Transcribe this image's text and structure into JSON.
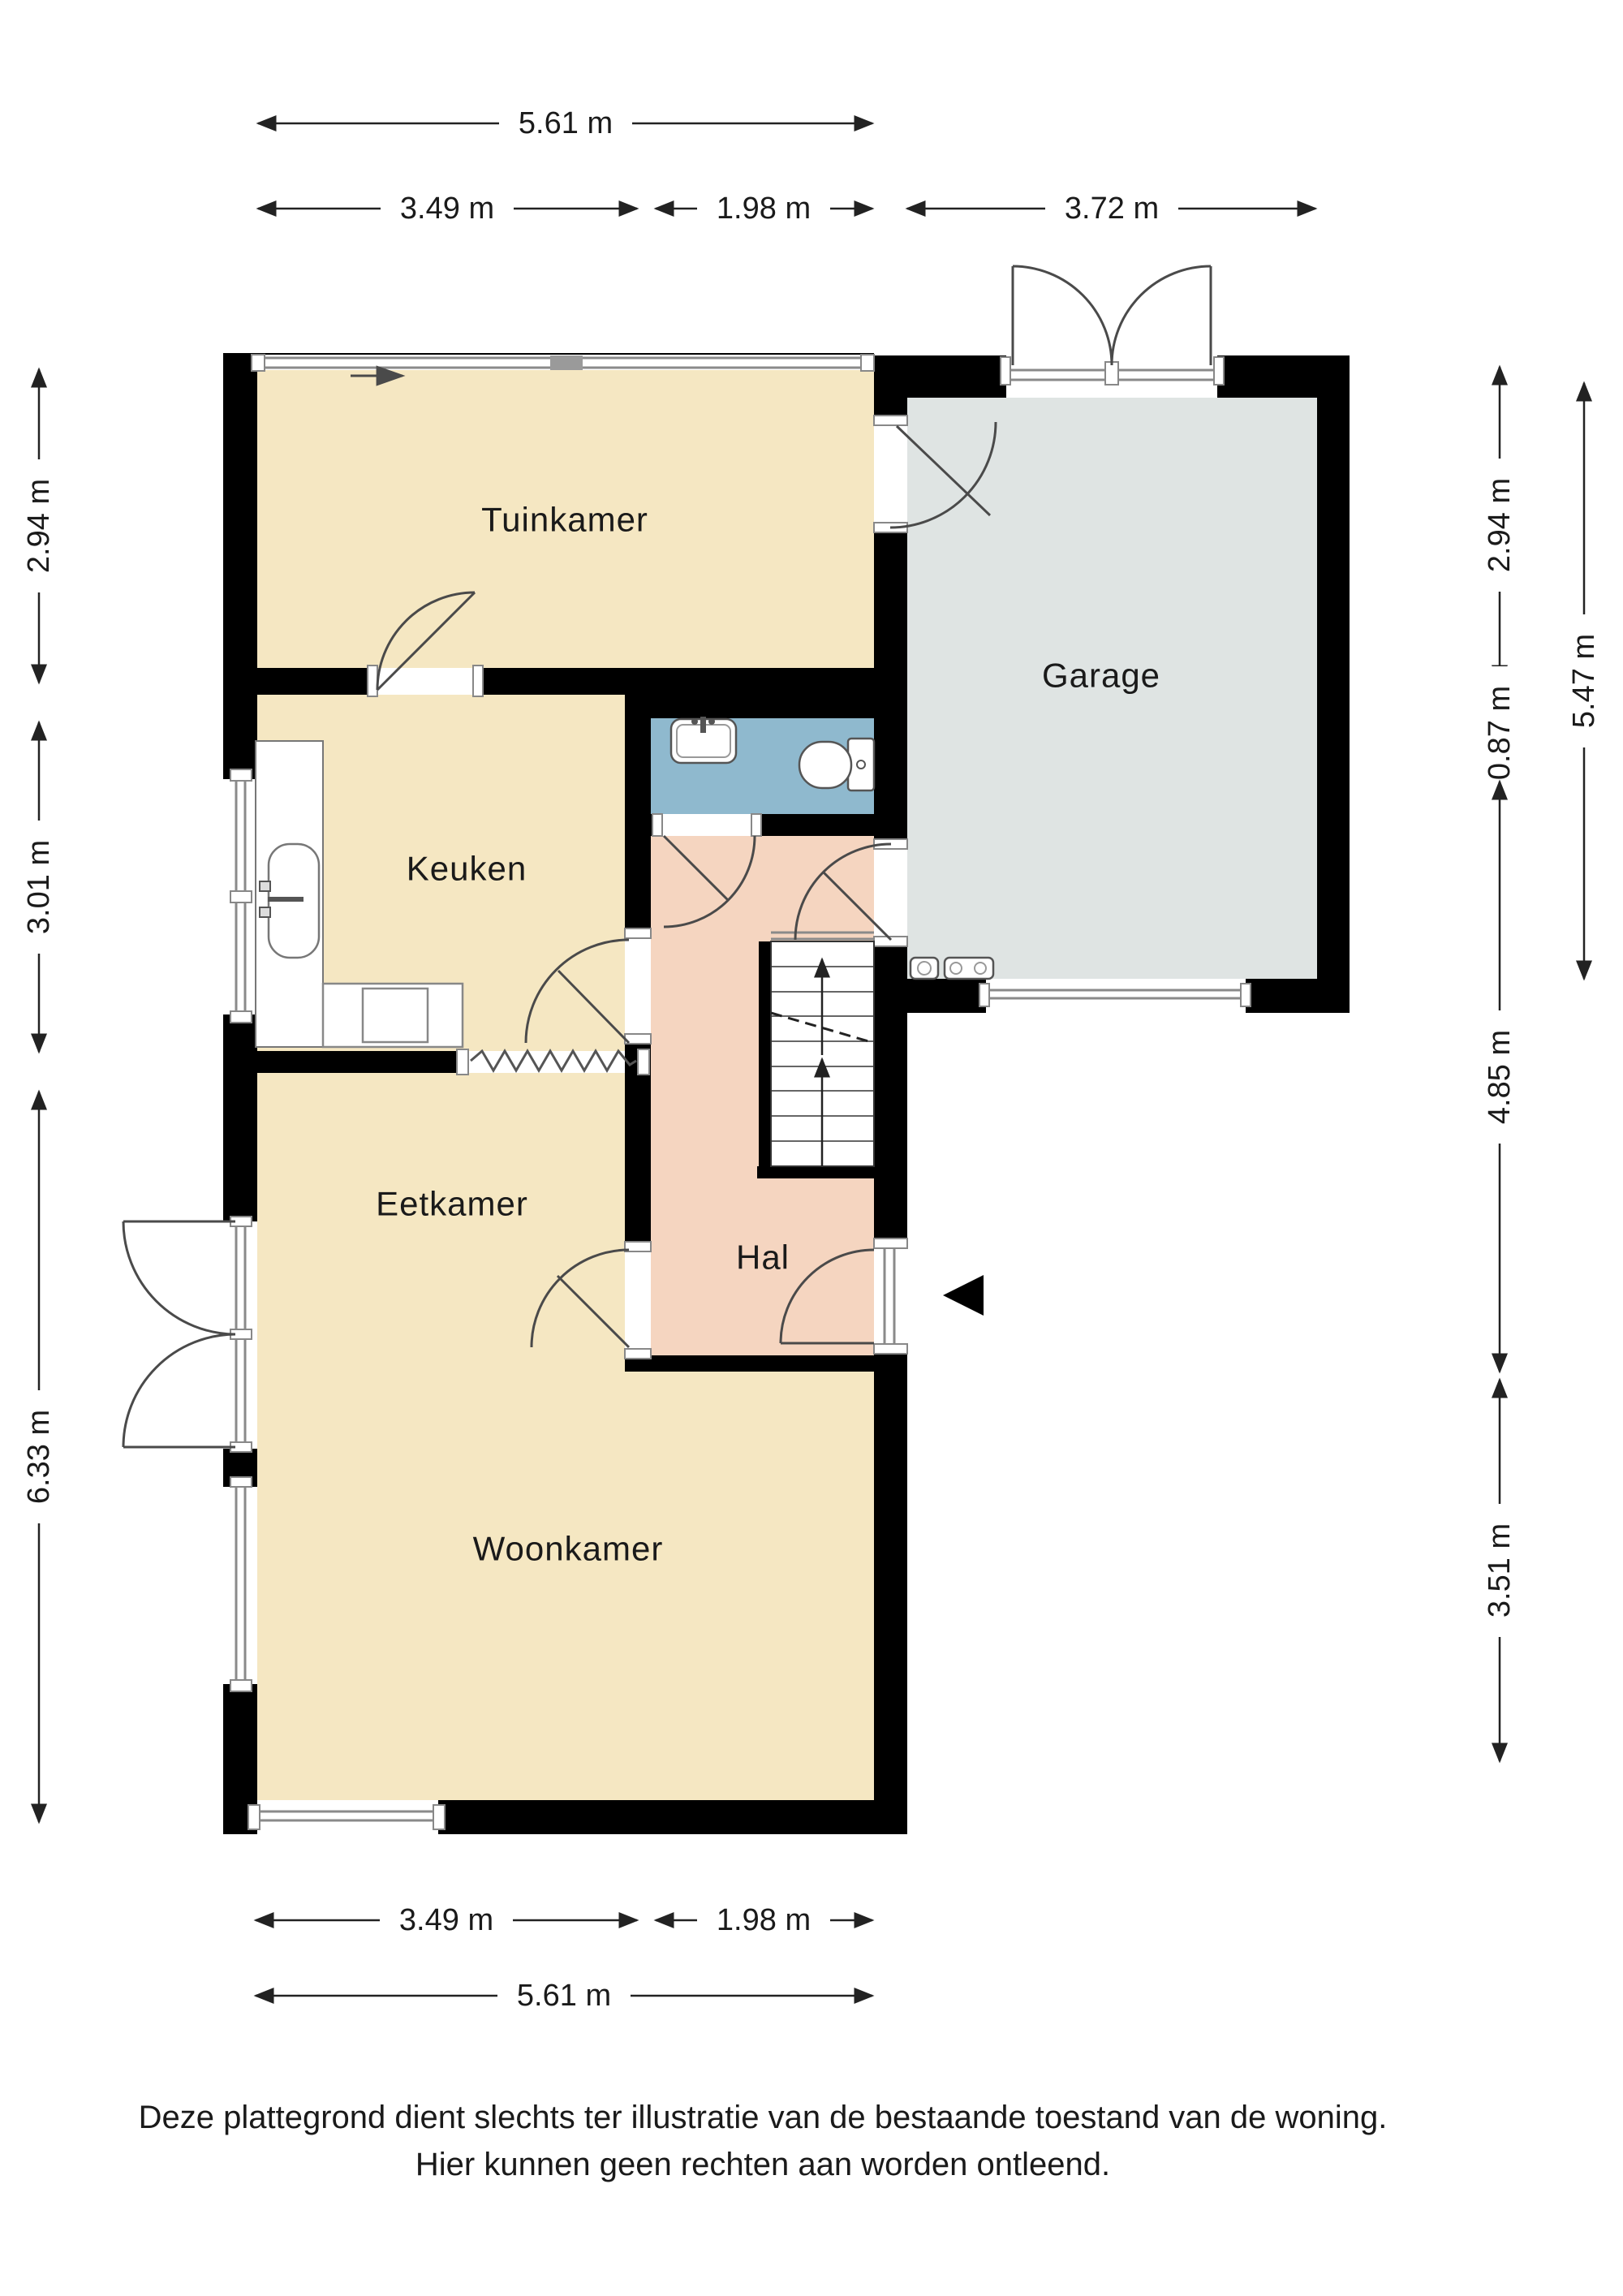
{
  "rooms": {
    "tuinkamer": {
      "label": "Tuinkamer"
    },
    "garage": {
      "label": "Garage"
    },
    "keuken": {
      "label": "Keuken"
    },
    "eetkamer": {
      "label": "Eetkamer"
    },
    "hal": {
      "label": "Hal"
    },
    "woonkamer": {
      "label": "Woonkamer"
    }
  },
  "dimensions": {
    "top_total": "5.61 m",
    "top_left": "3.49 m",
    "top_middle": "1.98 m",
    "top_garage": "3.72 m",
    "left_tuinkamer": "2.94 m",
    "left_keuken": "3.01 m",
    "left_living": "6.33 m",
    "right_tuinkamer": "2.94 m",
    "right_strip": "0.87 m",
    "right_hal": "4.85 m",
    "right_woonkamer": "3.51 m",
    "right_garage": "5.47 m",
    "bottom_left": "3.49 m",
    "bottom_middle": "1.98 m",
    "bottom_total": "5.61 m"
  },
  "disclaimer": {
    "line1": "Deze plattegrond dient slechts ter illustratie van de bestaande toestand van de woning.",
    "line2": "Hier kunnen geen rechten aan worden ontleend."
  },
  "colors": {
    "room_beige": "#F5E7C2",
    "room_gray": "#DFE4E3",
    "room_blue": "#8FB9CE",
    "room_salmon": "#F5D5C0",
    "wall": "#000000"
  }
}
